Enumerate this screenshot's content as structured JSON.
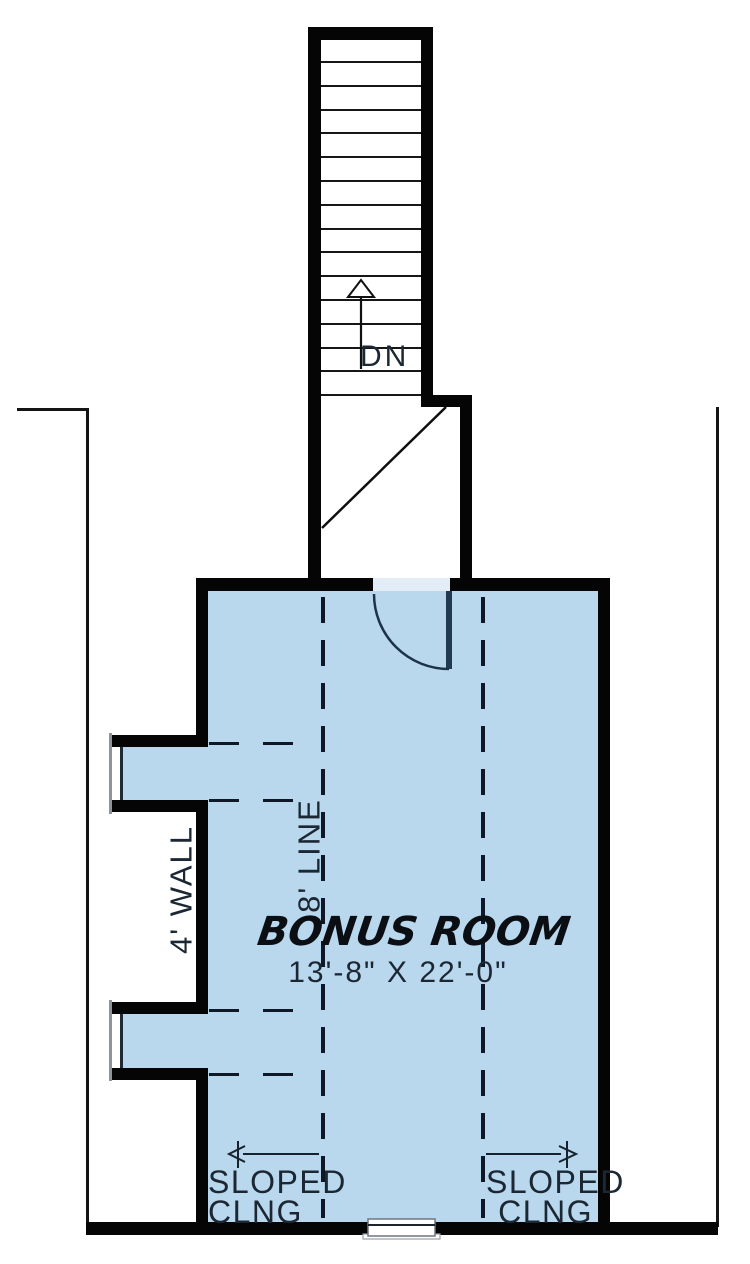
{
  "title": "Bonus Room Floor Plan",
  "stairs": {
    "dn_label": "DN",
    "tread_count": 15
  },
  "room": {
    "name": "BONUS ROOM",
    "dimensions": "13'-8\" X 22'-0\""
  },
  "annotations": {
    "ceiling_height_line": "8' LINE",
    "knee_wall": "4' WALL",
    "sloped_left": {
      "line1": "SLOPED",
      "line2": "CLNG"
    },
    "sloped_right": {
      "line1": "SLOPED",
      "line2": "CLNG"
    }
  },
  "colors": {
    "wall": "#050505",
    "room_fill": "#b9d7ed",
    "annotation_ink": "#1b2733",
    "dash_line": "#0e1826"
  }
}
